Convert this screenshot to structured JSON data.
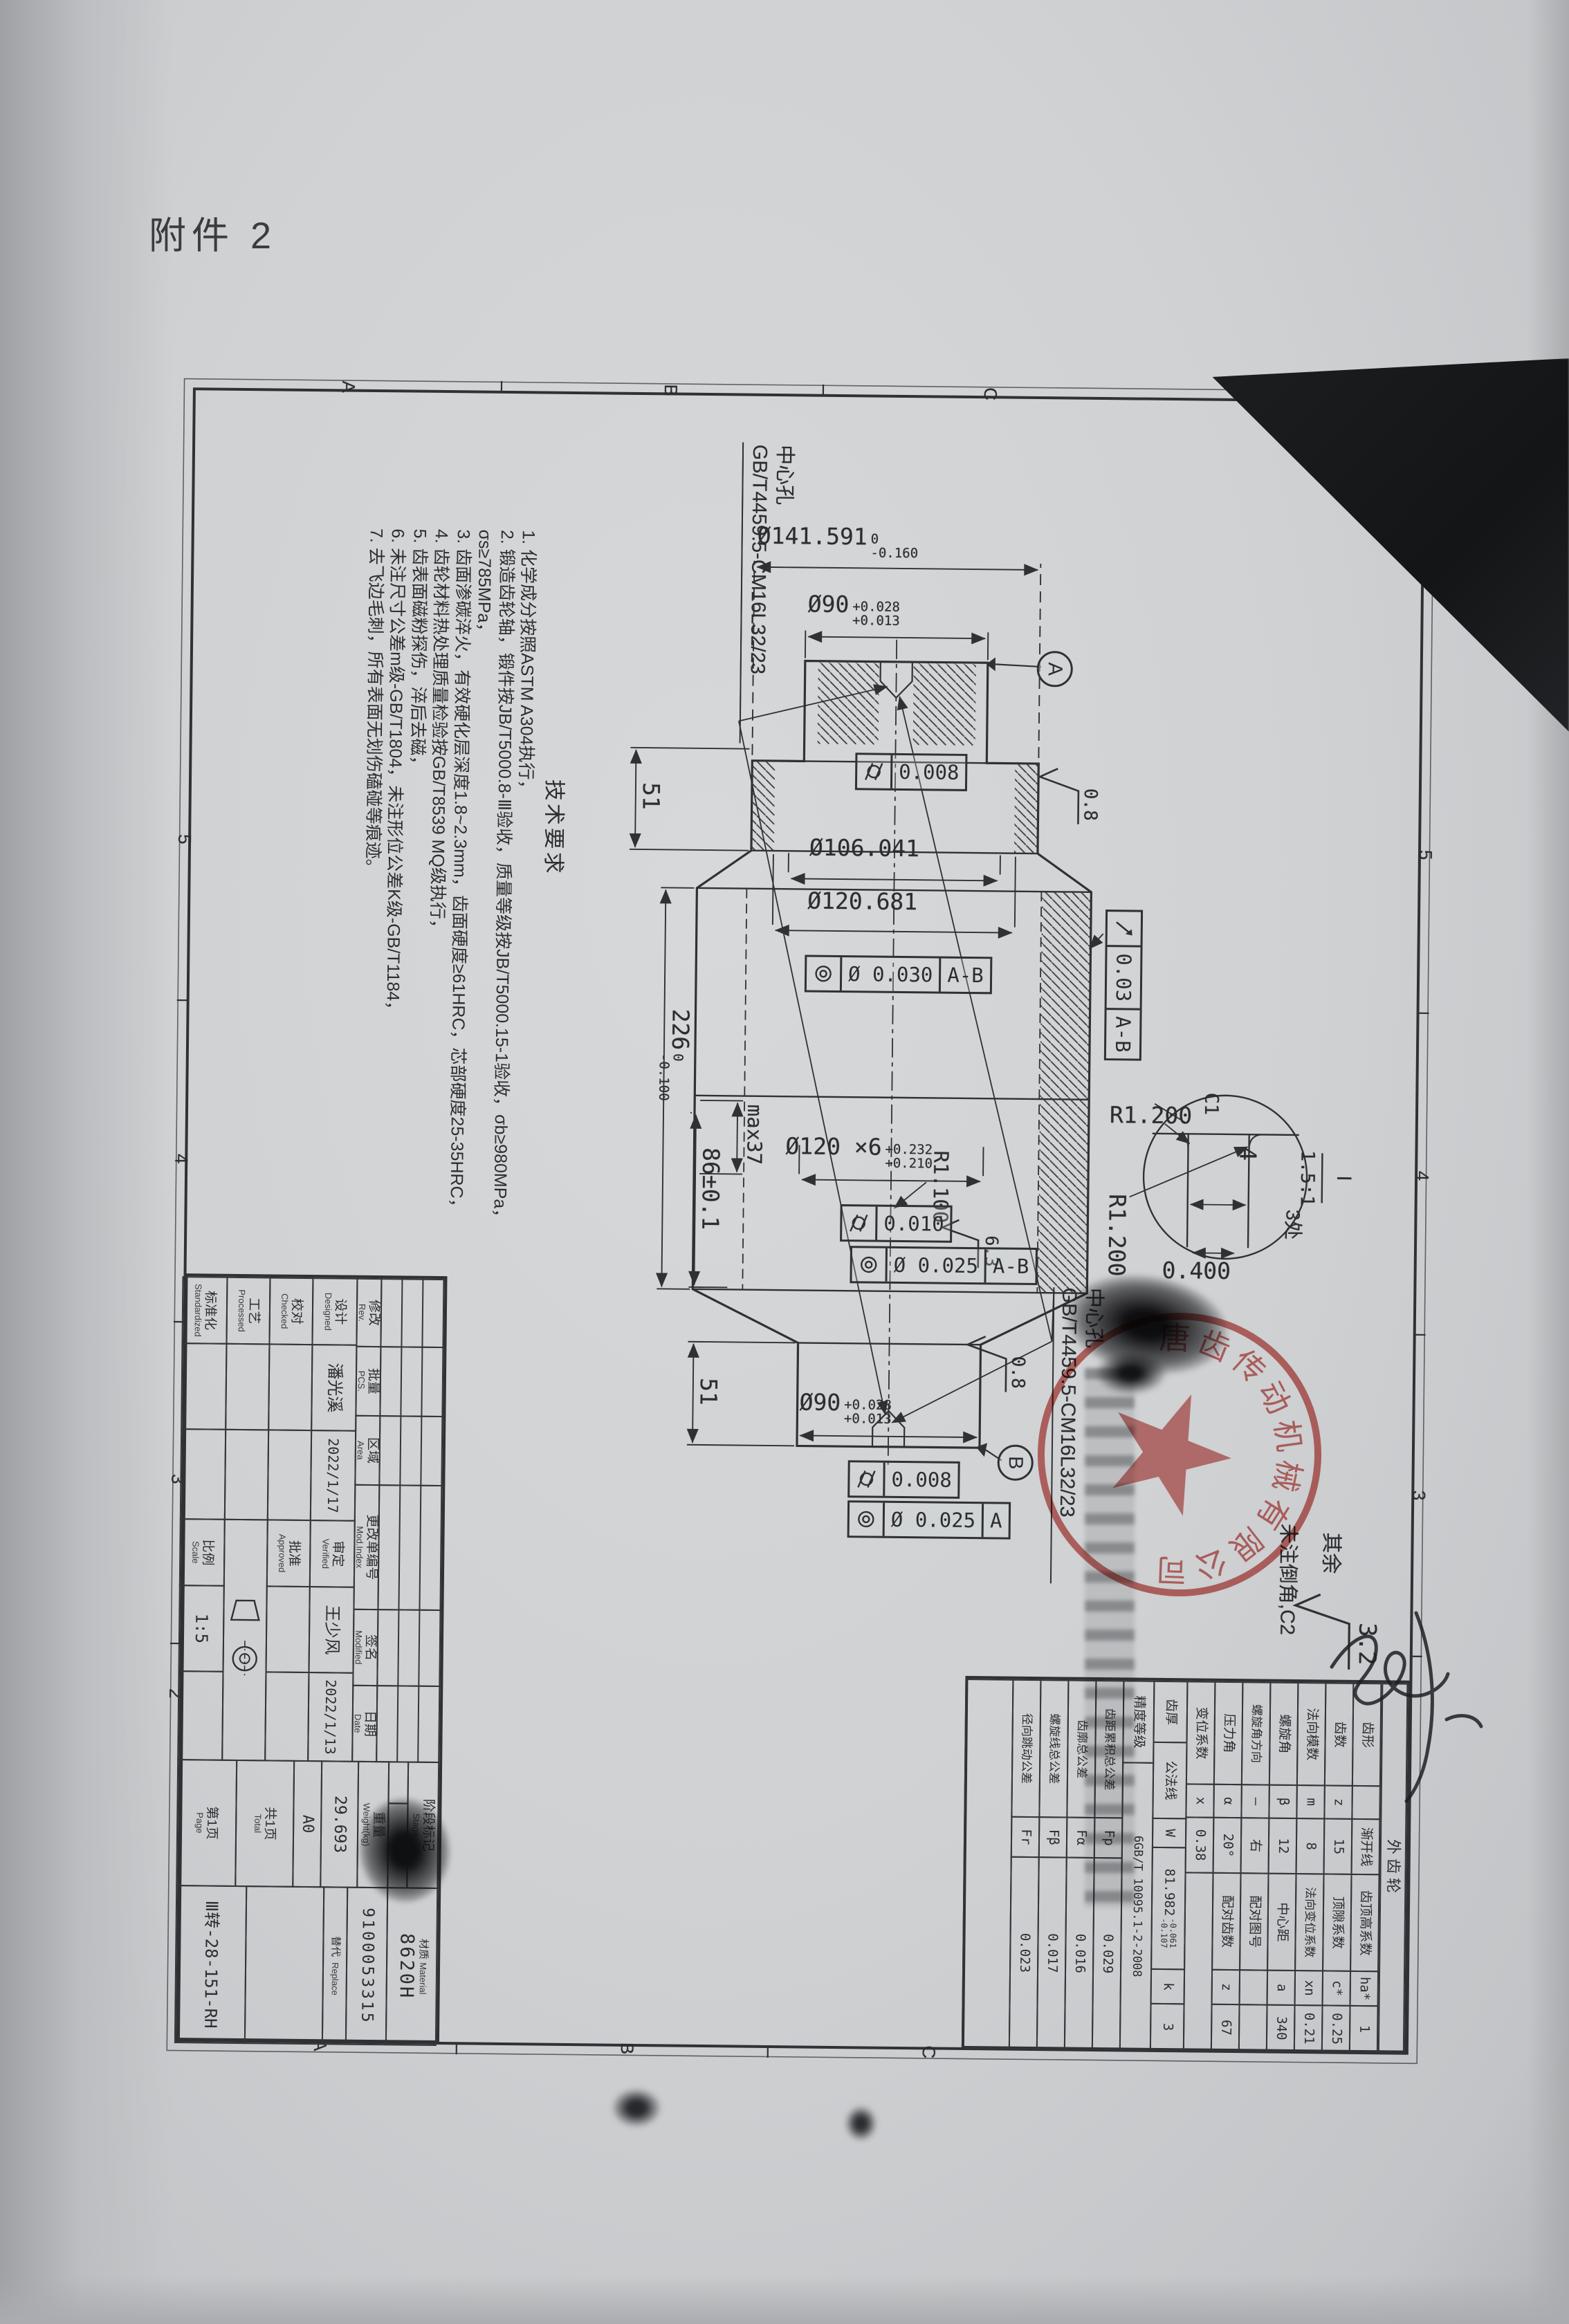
{
  "attachment_label": "附件 2",
  "notes": {
    "title": "技术要求",
    "items": [
      "1. 化学成分按照ASTM A304执行，",
      "2. 锻造齿轮轴，锻件按JB/T5000.8-Ⅲ验收，质量等级按JB/T5000.15-1验收，σb≥980MPa，σs≥785MPa，",
      "3. 齿面渗碳淬火，有效硬化层深度1.8~2.3mm，齿面硬度≥61HRC，芯部硬度25-35HRC，",
      "4. 齿轮材料热处理质量检验按GB/T8539 MQ级执行，",
      "5. 齿表面磁粉探伤，淬后去磁，",
      "6. 未注尺寸公差m级-GB/T1804，未注形位公差K级-GB/T1184，",
      "7. 去飞边毛刺，所有表面无划伤磕碰等痕迹。"
    ]
  },
  "center_hole": {
    "l1": "中心孔",
    "l2": "GB/T4459.5-CM16L32/23"
  },
  "dims": {
    "tip_od": {
      "v": "Ø141.591",
      "u": "0",
      "l": "-0.160"
    },
    "journal": {
      "v": "Ø90",
      "u": "+0.028",
      "l": "+0.013"
    },
    "root_od": "Ø106.041",
    "pin_od": "Ø120.681",
    "spline": {
      "v": "Ø120 ×6",
      "u": "+0.232",
      "l": "+0.210"
    },
    "length": {
      "v": "226",
      "u": "0",
      "l": "-0.100"
    },
    "spline_len": "86±0.1",
    "flank_max": "max37",
    "end_len": "51",
    "r1": "R1.200",
    "r2": "R1.100",
    "depth": "0.400",
    "groove": "4",
    "chamfer_c1": "C1",
    "detail_id": "Ⅰ",
    "detail_scale": "1.5:1",
    "detail_places": "3处"
  },
  "roughness": {
    "fine": "0.8",
    "medium": "6.3",
    "general": "3.2",
    "rest_label": "其余",
    "chamfer_note": "未注倒角,C2"
  },
  "gdt": {
    "cyl_tight": "0.008",
    "conc_mid": "0.030",
    "runout": "0.03",
    "cyl_spline": "0.010",
    "conc_spline": "0.025",
    "dia": "Ø",
    "ref_ab": "A-B",
    "ref_a": "A",
    "datum_a": "A",
    "datum_b": "B"
  },
  "zones": {
    "letters": [
      "A",
      "B",
      "C"
    ],
    "numbers": [
      "5",
      "4",
      "3",
      "2"
    ]
  },
  "gear_table": {
    "title": "外齿轮",
    "rows": [
      [
        "齿形",
        "",
        "渐开线",
        "齿顶高系数",
        "ha*",
        "1"
      ],
      [
        "齿数",
        "z",
        "15",
        "顶隙系数",
        "c*",
        "0.25"
      ],
      [
        "法向模数",
        "m",
        "8",
        "法向变位系数",
        "xn",
        "0.21"
      ],
      [
        "螺旋角",
        "β",
        "12",
        "中心距",
        "a",
        "340"
      ],
      [
        "螺旋角方向",
        "—",
        "右",
        "配对图号",
        "",
        ""
      ],
      [
        "压力角",
        "α",
        "20°",
        "配对齿数",
        "z",
        "67"
      ],
      [
        "变位系数",
        "x",
        "0.38",
        "",
        "",
        ""
      ]
    ],
    "thick": {
      "c1": "齿厚",
      "c2": "公法线",
      "sym": "W",
      "v": "81.982",
      "u": "-0.061",
      "l": "-0.107",
      "k_label": "k",
      "k": "3"
    },
    "grade": {
      "label": "精度等级",
      "v": "6GB/T 10095.1-2-2008"
    },
    "tols": [
      [
        "齿距累积总公差",
        "Fp",
        "0.029"
      ],
      [
        "齿廓总公差",
        "Fα",
        "0.016"
      ],
      [
        "螺旋线总公差",
        "Fβ",
        "0.017"
      ],
      [
        "径向跳动公差",
        "Fr",
        "0.023"
      ]
    ]
  },
  "title_block": {
    "rev_cols": [
      {
        "cn": "修改",
        "en": "Rev."
      },
      {
        "cn": "批量",
        "en": "PCS."
      },
      {
        "cn": "区域",
        "en": "Area"
      },
      {
        "cn": "更改单编号",
        "en": "Mod.Index"
      },
      {
        "cn": "签名",
        "en": "Modified"
      },
      {
        "cn": "日期",
        "en": "Date"
      }
    ],
    "staff": [
      {
        "cn": "设计",
        "en": "Designed",
        "name": "潘光溪",
        "date": "2022/1/17"
      },
      {
        "cn": "校对",
        "en": "Checked",
        "name": "",
        "date": ""
      },
      {
        "cn": "工艺",
        "en": "Processed",
        "name": "",
        "date": ""
      },
      {
        "cn": "标准化",
        "en": "Standardized",
        "name": "",
        "date": ""
      }
    ],
    "staff2": [
      {
        "cn": "审定",
        "en": "Verified",
        "name": "王少风",
        "date": "2022/1/13"
      },
      {
        "cn": "批准",
        "en": "Approved",
        "name": "",
        "date": ""
      }
    ],
    "scale": {
      "cn": "比例",
      "en": "Scale",
      "v": "1:5"
    },
    "stage": {
      "cn": "阶段标记",
      "en": "Stage"
    },
    "weight": {
      "cn": "重量",
      "en": "Weight(kg)",
      "v": "29.693"
    },
    "sheet_size": "A0",
    "pages": {
      "t_cn": "共1页",
      "t_en": "Total",
      "p_cn": "第1页",
      "p_en": "Page"
    },
    "material": {
      "cn": "材质",
      "en": "Material",
      "v": "8620H"
    },
    "code": "9100053315",
    "replace": {
      "cn": "替代",
      "en": "Replace"
    },
    "part_no": "Ⅲ转-28-151-RH"
  },
  "stamp": {
    "arc": "唐齿传动机械有限公司"
  }
}
